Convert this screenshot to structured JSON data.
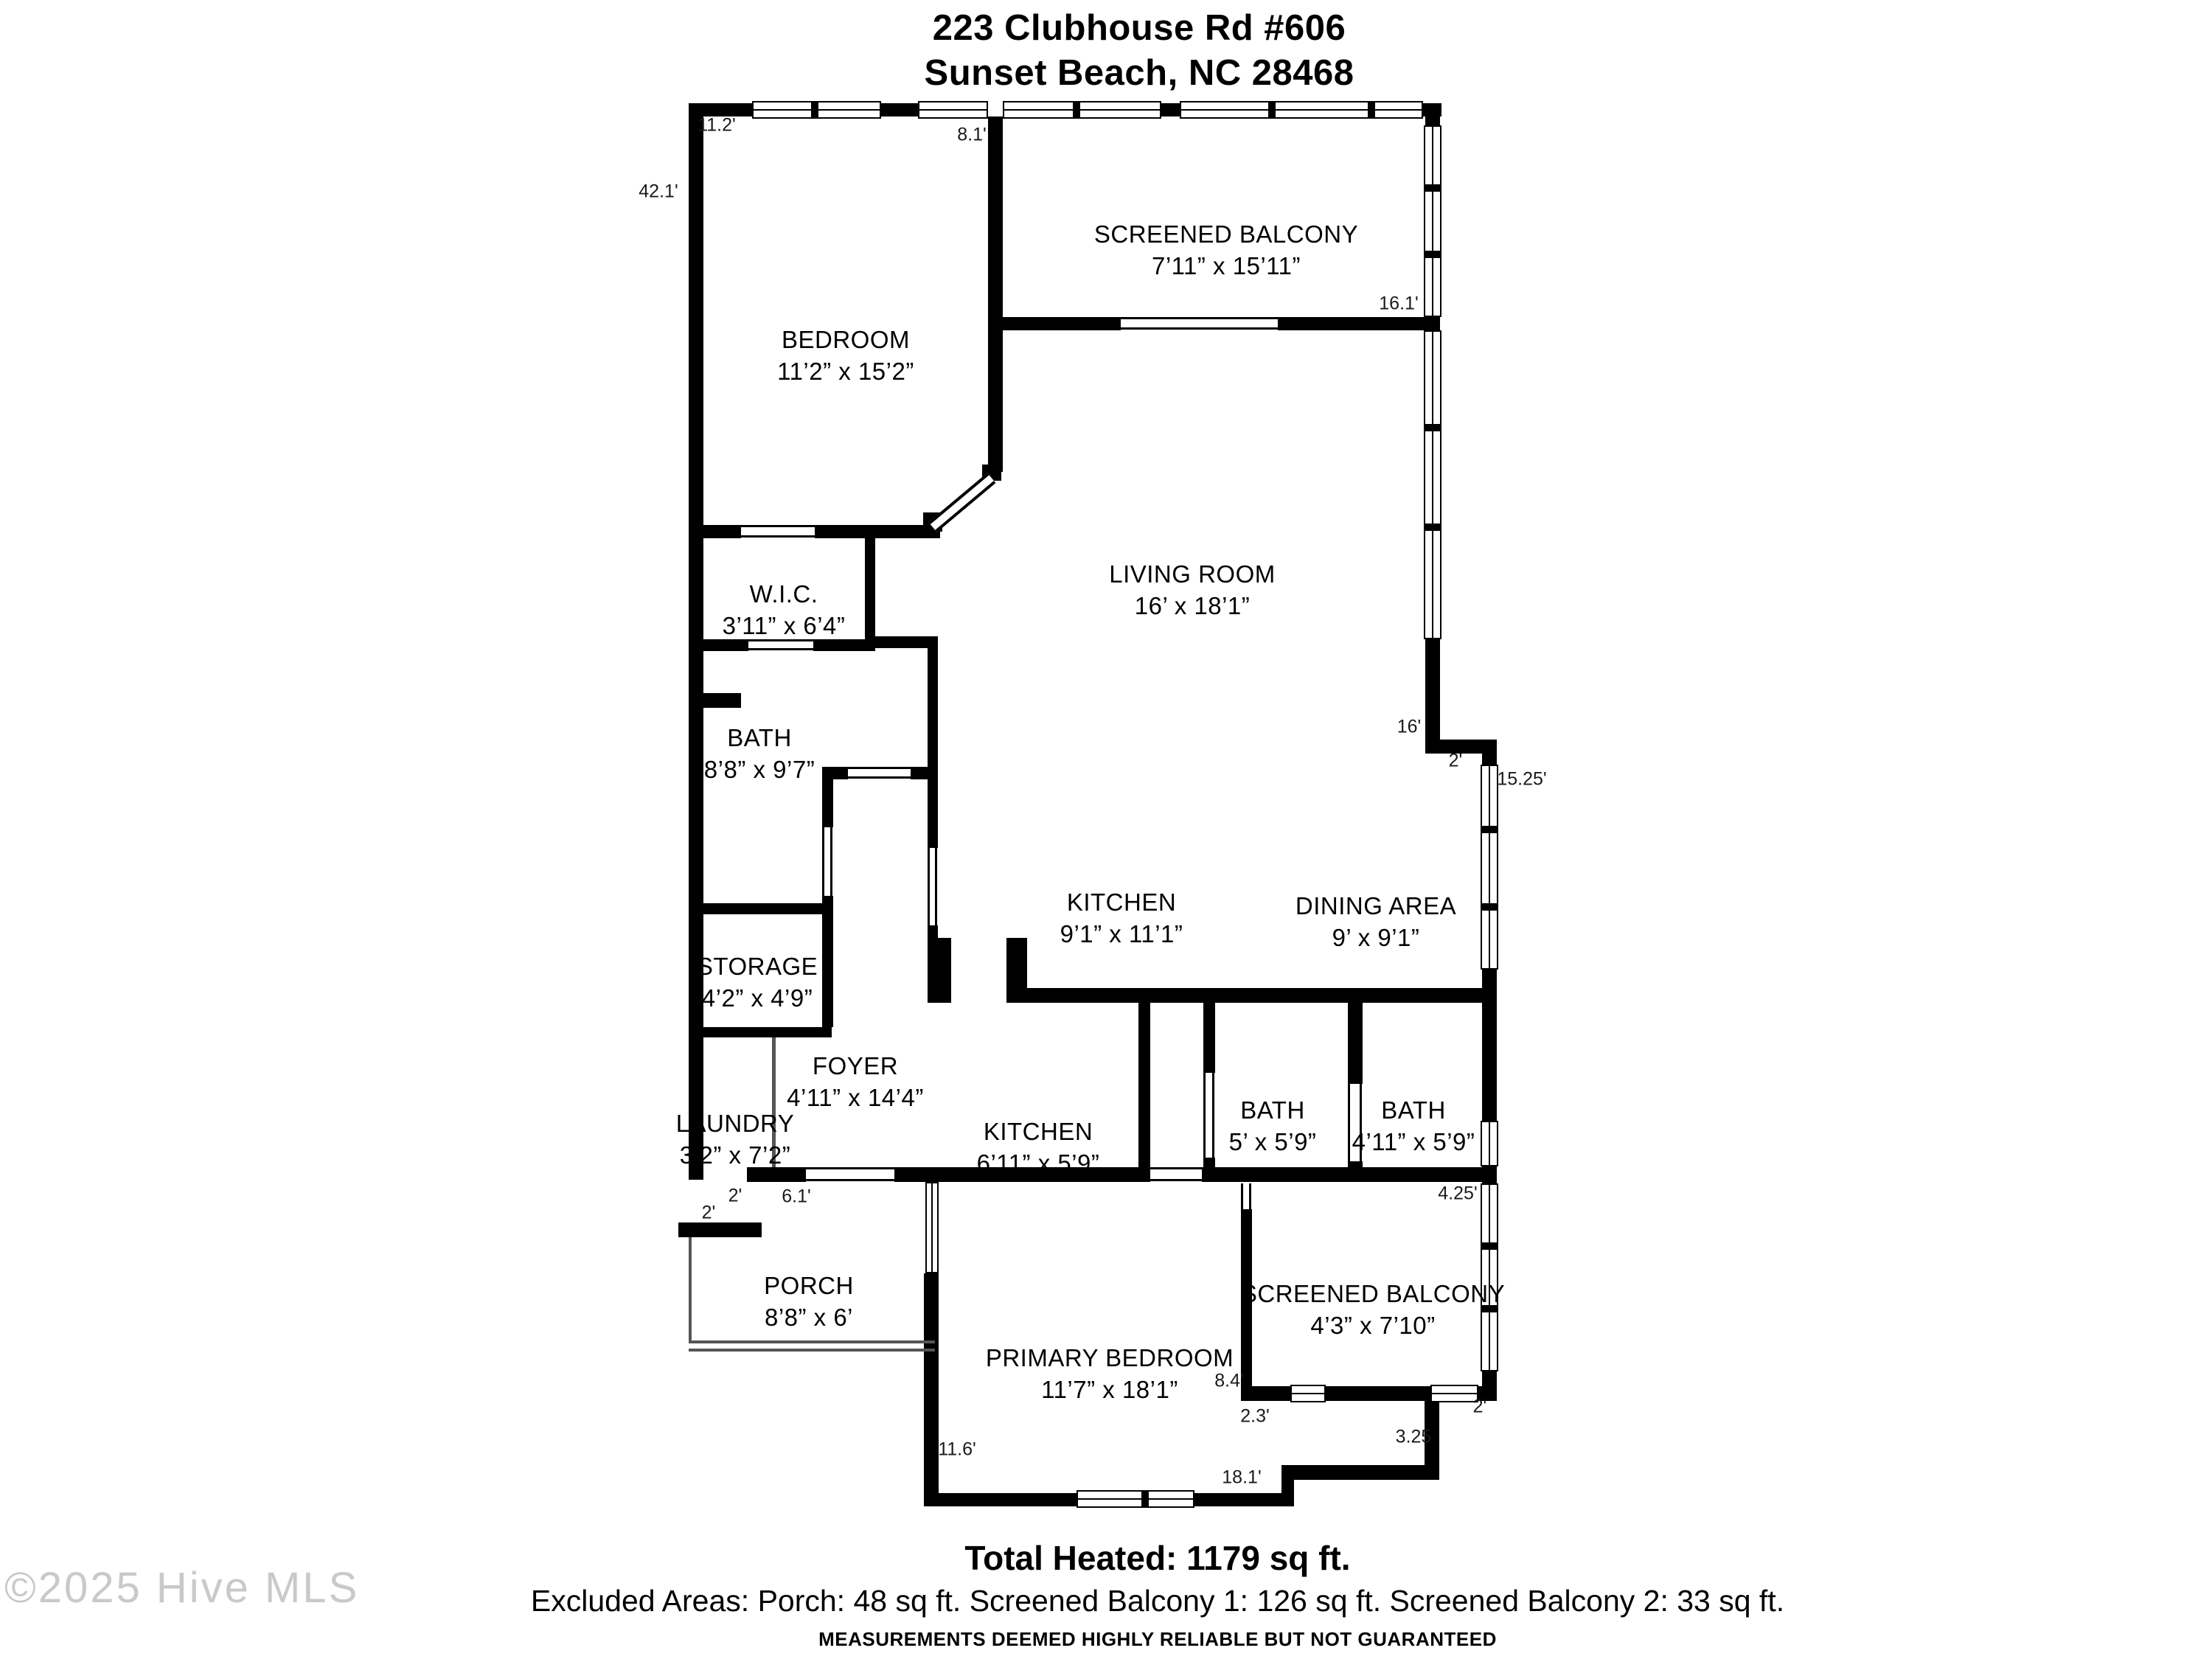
{
  "header": {
    "address_line1": "223 Clubhouse Rd #606",
    "address_line2": "Sunset Beach, NC 28468"
  },
  "rooms": [
    {
      "id": "bedroom",
      "label": "BEDROOM",
      "dims": "11’2” x 15’2”"
    },
    {
      "id": "screened-balcony-1",
      "label": "SCREENED BALCONY",
      "dims": "7’11” x 15’11”"
    },
    {
      "id": "living-room",
      "label": "LIVING ROOM",
      "dims": "16’ x 18’1”"
    },
    {
      "id": "wic",
      "label": "W.I.C.",
      "dims": "3’11” x 6’4”"
    },
    {
      "id": "bath-main",
      "label": "BATH",
      "dims": "8’8” x 9’7”"
    },
    {
      "id": "kitchen-main",
      "label": "KITCHEN",
      "dims": "9’1” x 11’1”"
    },
    {
      "id": "dining-area",
      "label": "DINING AREA",
      "dims": "9’ x 9’1”"
    },
    {
      "id": "storage",
      "label": "STORAGE",
      "dims": "4’2” x 4’9”"
    },
    {
      "id": "foyer",
      "label": "FOYER",
      "dims": "4’11” x 14’4”"
    },
    {
      "id": "laundry",
      "label": "LAUNDRY",
      "dims": "3’2” x 7’2”"
    },
    {
      "id": "kitchen-2",
      "label": "KITCHEN",
      "dims": "6’11” x 5’9”"
    },
    {
      "id": "bath-2",
      "label": "BATH",
      "dims": "5’ x 5’9”"
    },
    {
      "id": "bath-3",
      "label": "BATH",
      "dims": "4’11” x 5’9”"
    },
    {
      "id": "porch",
      "label": "PORCH",
      "dims": "8’8” x 6’"
    },
    {
      "id": "primary-bedroom",
      "label": "PRIMARY BEDROOM",
      "dims": "11’7” x 18’1”"
    },
    {
      "id": "screened-balcony-2",
      "label": "SCREENED BALCONY",
      "dims": "4’3” x 7’10”"
    }
  ],
  "edge_dimensions": [
    {
      "id": "bedroom-top-width",
      "text": "11.2'"
    },
    {
      "id": "balcony1-left-height",
      "text": "8.1'"
    },
    {
      "id": "left-side-height",
      "text": "42.1'"
    },
    {
      "id": "balcony1-right-height",
      "text": "16.1'"
    },
    {
      "id": "living-right-height",
      "text": "16'"
    },
    {
      "id": "right-step-width",
      "text": "2'"
    },
    {
      "id": "dining-right-height",
      "text": "15.25'"
    },
    {
      "id": "balcony2-right-height",
      "text": "4.25'"
    },
    {
      "id": "balcony2-left-height",
      "text": "8.4'"
    },
    {
      "id": "balcony2-step-width",
      "text": "2.3'"
    },
    {
      "id": "balcony2-door-width",
      "text": "2'"
    },
    {
      "id": "balcony2-step-height",
      "text": "3.25"
    },
    {
      "id": "primary-bottom-width",
      "text": "18.1'"
    },
    {
      "id": "primary-left-height",
      "text": "11.6'"
    },
    {
      "id": "notch-width",
      "text": "2'"
    },
    {
      "id": "notch-height",
      "text": "2'"
    },
    {
      "id": "porch-top-width",
      "text": "6.1'"
    }
  ],
  "footer": {
    "total_heated": "Total Heated: 1179 sq ft.",
    "excluded": "Excluded Areas: Porch: 48 sq ft. Screened Balcony 1: 126 sq ft. Screened Balcony 2: 33 sq ft.",
    "disclaimer": "MEASUREMENTS DEEMED HIGHLY RELIABLE BUT NOT GUARANTEED"
  },
  "watermark": "©2025 Hive MLS",
  "colors": {
    "wall": "#000000",
    "background": "#ffffff",
    "watermark": "#c9c9c9"
  }
}
